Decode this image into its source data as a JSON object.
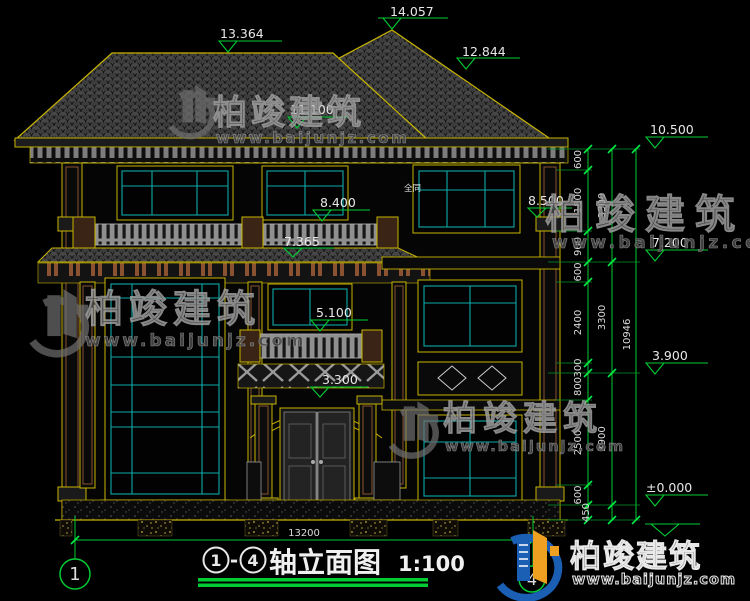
{
  "drawing": {
    "title": {
      "axis_start": "1",
      "axis_sep": "-",
      "axis_end": "4",
      "name": "轴立面图",
      "scale": "1:100"
    },
    "axis_bubbles": {
      "left": "1",
      "right": "4"
    },
    "levels": {
      "ridge_left": "13.364",
      "ridge_main": "14.057",
      "ridge_right": "12.844",
      "eave": "11.100",
      "balcony_3f": "8.400",
      "cornice_3f": "7.365",
      "rail_2f": "5.100",
      "porch": "3.300",
      "capital_right": "8.500",
      "right_top": "10.500",
      "right_mid": "7.200",
      "right_low": "3.900",
      "right_zero": "±0.000"
    },
    "dims": {
      "chain_a": [
        "600",
        "1800",
        "900",
        "600",
        "2400",
        "300",
        "800",
        "2500",
        "600",
        "450"
      ],
      "chain_b": [
        "3300",
        "3300",
        "3900"
      ],
      "total": "10946",
      "width": "13200"
    },
    "notes": {
      "window": "全同"
    }
  },
  "watermark": {
    "brand": "柏竣建筑",
    "url": "www.baijunjz.com"
  },
  "colors": {
    "line_yellow": "#c8b400",
    "dim_green": "#00cc33",
    "glass_cyan": "#0fa8a8",
    "text_white": "#e8e8e8",
    "wood_brown": "#8a5230",
    "brand_blue": "#1a5fb4",
    "brand_orange": "#f0a020",
    "background": "#000000"
  }
}
